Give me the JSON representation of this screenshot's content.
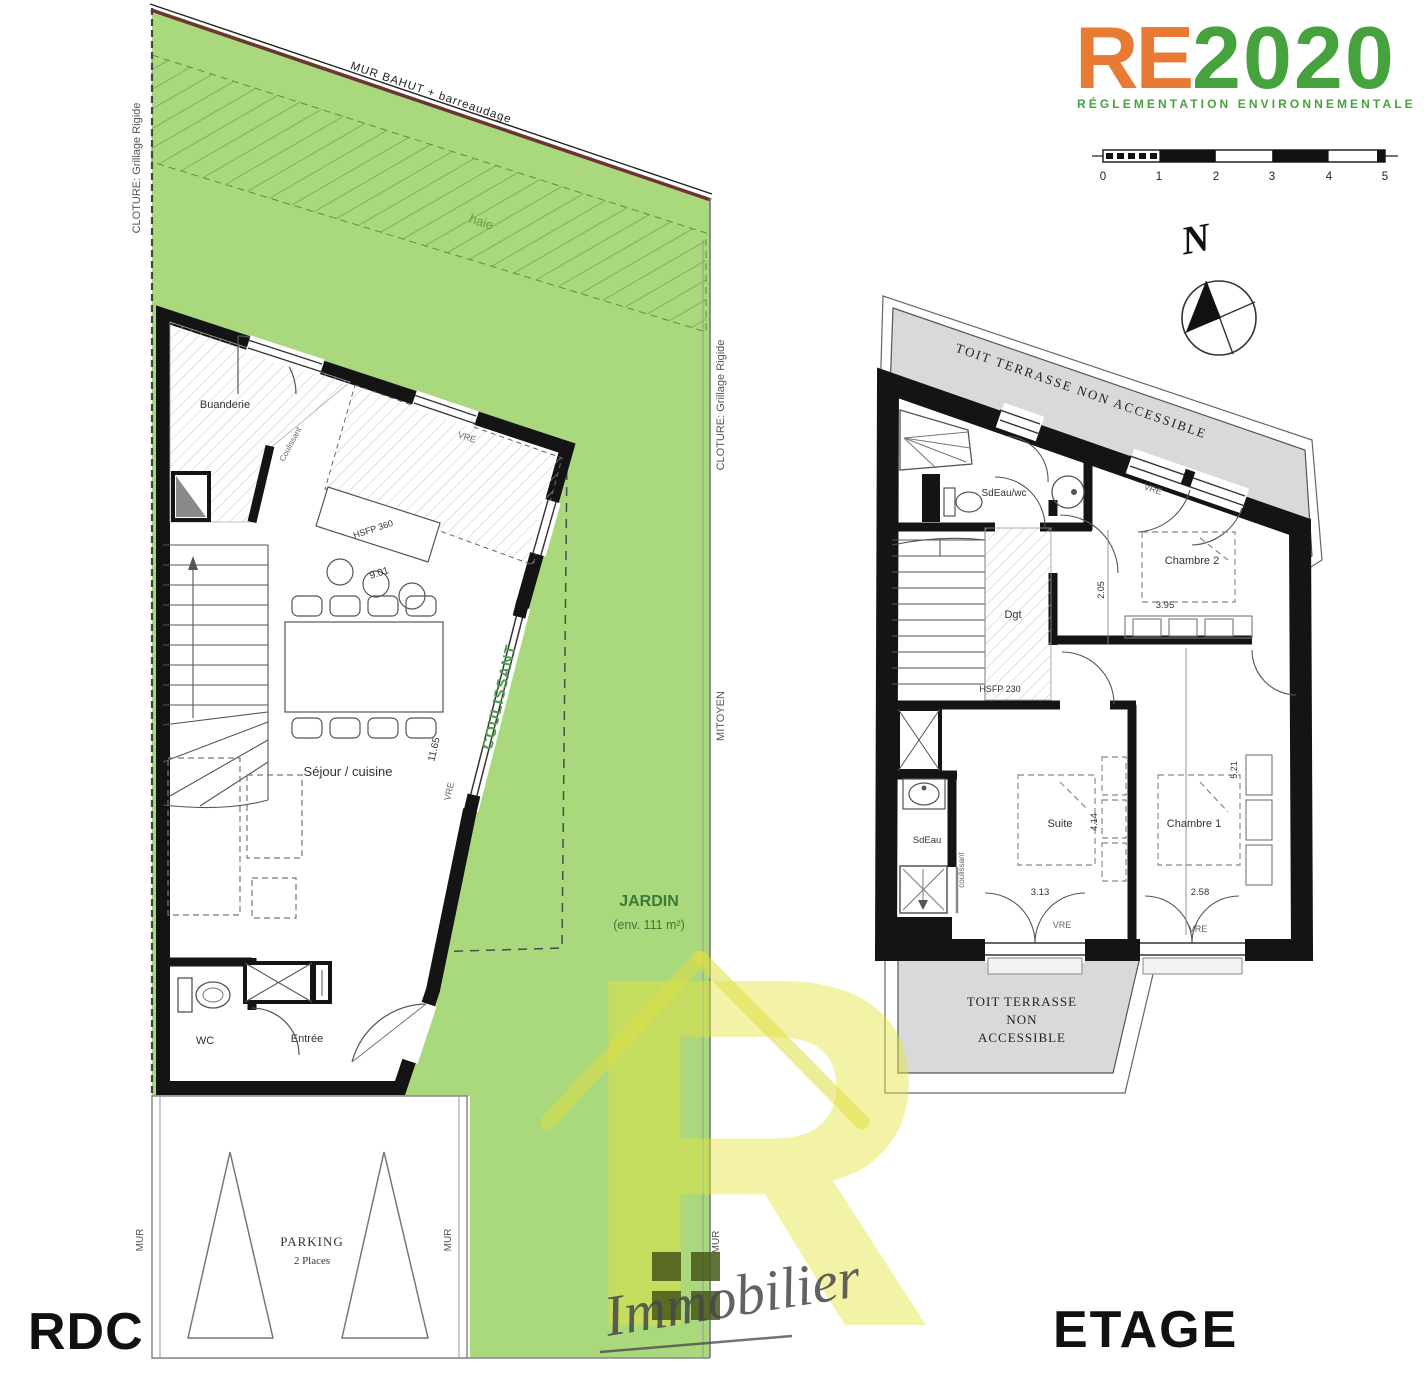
{
  "logo": {
    "re": "RE",
    "year": "2020",
    "subtitle": "RÉGLEMENTATION ENVIRONNEMENTALE",
    "re_color": "#e87a33",
    "green_color": "#46a23c"
  },
  "scalebar": {
    "t0": "0",
    "t1": "1",
    "t2": "2",
    "t3": "3",
    "t4": "4",
    "t5": "5"
  },
  "compass": {
    "n": "N"
  },
  "rdc": {
    "floor_label": "RDC",
    "mur_bahut": "MUR BAHUT  + barreaudage",
    "cloture_left": "CLOTURE: Grillage Rigide",
    "cloture_right": "CLOTURE: Grillage Rigide",
    "mitoyen": "MITOYEN",
    "haie": "haie",
    "jardin_title": "JARDIN",
    "jardin_area": "(env. 111 m²)",
    "buanderie": "Buanderie",
    "coulissant_partition": "Coulissant",
    "sejour": "Séjour / cuisine",
    "hsfp": "HSFP 360",
    "dim_901": "9.01",
    "dim_1165": "11.65",
    "vre_top": "VRE",
    "vre_side": "VRE",
    "coulissant_bay": "COULISSANT",
    "wc": "WC",
    "entree": "Entrée",
    "parking_title": "PARKING",
    "parking_sub": "2 Places",
    "mur_left": "MUR",
    "mur_right": "MUR",
    "mur_far": "MUR"
  },
  "etage": {
    "floor_label": "ETAGE",
    "toit_top": "TOIT TERRASSE  NON ACCESSIBLE",
    "toit_bottom_1": "TOIT TERRASSE",
    "toit_bottom_2": "NON",
    "toit_bottom_3": "ACCESSIBLE",
    "sdeau_wc": "SdEau/wc",
    "vre_top": "VRE",
    "chambre2": "Chambre 2",
    "dim_205": "2.05",
    "dim_395": "3.95",
    "dgt": "Dgt",
    "hsfp": "HSFP 230",
    "sdeau": "SdEau",
    "coulissant": "coulissant",
    "suite": "Suite",
    "dim_414": "4.14",
    "dim_313": "3.13",
    "chambre1": "Chambre 1",
    "dim_521": "5.21",
    "dim_258": "2.58",
    "vre_b1": "VRE",
    "vre_b2": "VRE"
  },
  "watermark": {
    "letter": "R",
    "script": "Immobilier"
  },
  "colors": {
    "garden": "#a9d87d",
    "hedge_line": "#74a855",
    "mur_bahut_line": "#6b3535",
    "wall": "#141414",
    "terrace_gray": "#d9d9d9",
    "coulissant_green": "#4f9e4f",
    "jardin_text": "#3c7a38",
    "watermark_yellow": "#e4e43c"
  }
}
